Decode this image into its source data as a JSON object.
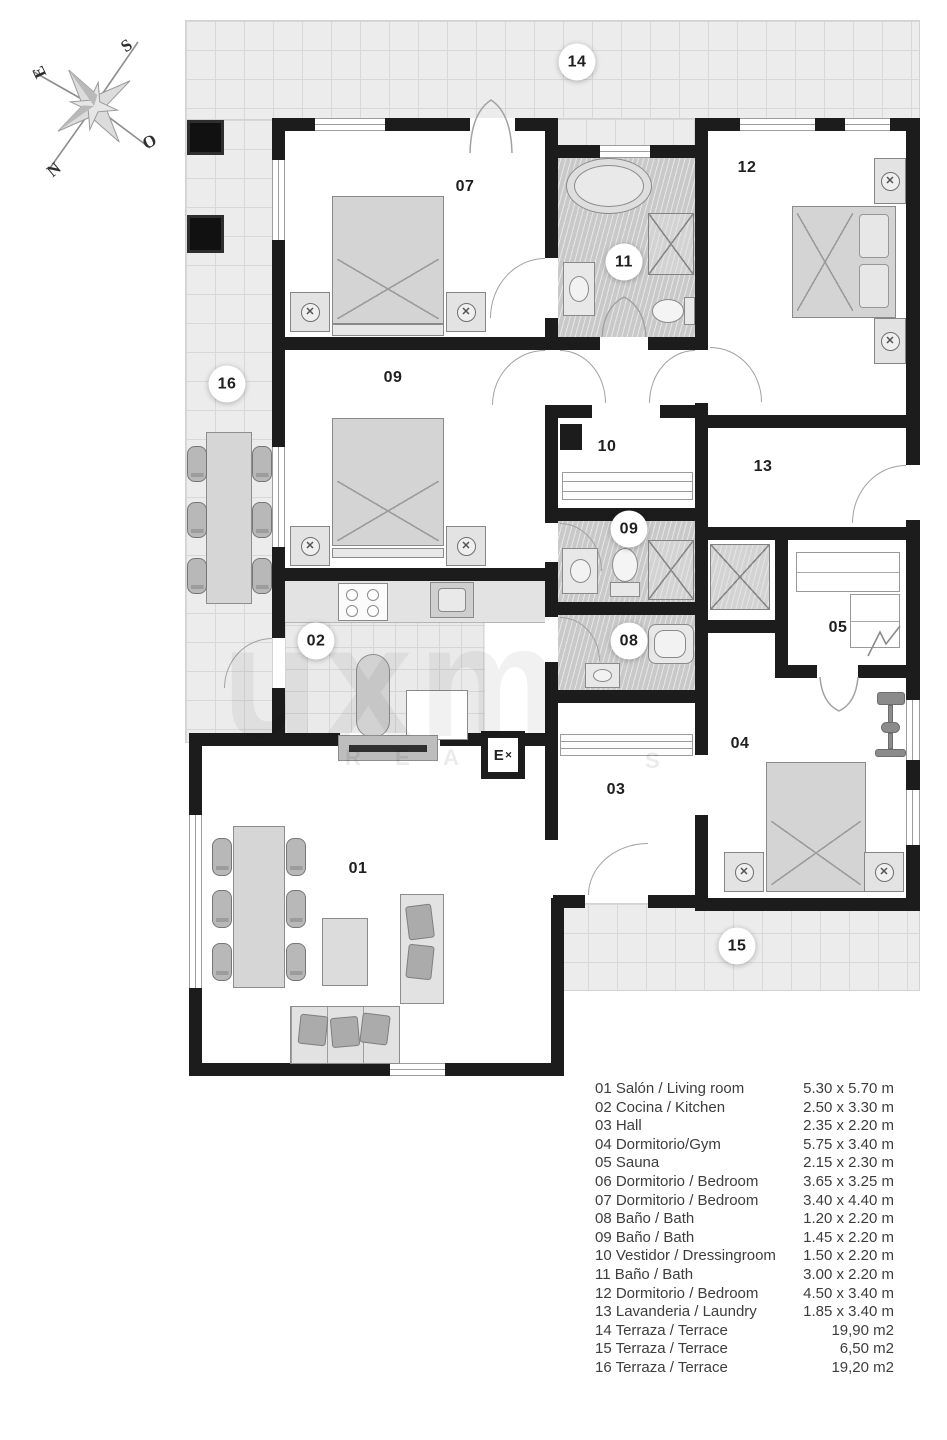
{
  "compass": {
    "n": "N",
    "s": "S",
    "e": "E",
    "o": "O"
  },
  "watermark": {
    "big": "uxm",
    "small_left": "R E A",
    "small_right": "S"
  },
  "entry": {
    "letter": "E"
  },
  "icons": {
    "lamp": "✕"
  },
  "room_labels": [
    {
      "key": "14",
      "label": "14",
      "circled": true
    },
    {
      "key": "16",
      "label": "16",
      "circled": true
    },
    {
      "key": "07",
      "label": "07",
      "circled": false
    },
    {
      "key": "11",
      "label": "11",
      "circled": true
    },
    {
      "key": "12",
      "label": "12",
      "circled": false
    },
    {
      "key": "09a",
      "label": "09",
      "circled": false
    },
    {
      "key": "10",
      "label": "10",
      "circled": false
    },
    {
      "key": "13",
      "label": "13",
      "circled": false
    },
    {
      "key": "09b",
      "label": "09",
      "circled": true
    },
    {
      "key": "05",
      "label": "05",
      "circled": false
    },
    {
      "key": "08",
      "label": "08",
      "circled": true
    },
    {
      "key": "02",
      "label": "02",
      "circled": true
    },
    {
      "key": "04",
      "label": "04",
      "circled": false
    },
    {
      "key": "03",
      "label": "03",
      "circled": false
    },
    {
      "key": "01",
      "label": "01",
      "circled": false
    },
    {
      "key": "15",
      "label": "15",
      "circled": true
    }
  ],
  "legend": {
    "rows": [
      {
        "no": "01",
        "name": "Salón / Living room",
        "size": "5.30 x 5.70 m"
      },
      {
        "no": "02",
        "name": "Cocina / Kitchen",
        "size": "2.50 x 3.30 m"
      },
      {
        "no": "03",
        "name": "Hall",
        "size": "2.35 x 2.20 m"
      },
      {
        "no": "04",
        "name": "Dormitorio/Gym",
        "size": "5.75 x 3.40 m"
      },
      {
        "no": "05",
        "name": "Sauna",
        "size": "2.15 x 2.30 m"
      },
      {
        "no": "06",
        "name": "Dormitorio / Bedroom",
        "size": "3.65 x 3.25 m"
      },
      {
        "no": "07",
        "name": "Dormitorio / Bedroom",
        "size": "3.40 x 4.40 m"
      },
      {
        "no": "08",
        "name": "Baño / Bath",
        "size": "1.20 x 2.20 m"
      },
      {
        "no": "09",
        "name": "Baño / Bath",
        "size": "1.45 x 2.20 m"
      },
      {
        "no": "10",
        "name": "Vestidor / Dressingroom",
        "size": "1.50 x 2.20 m"
      },
      {
        "no": "11",
        "name": "Baño / Bath",
        "size": "3.00 x 2.20 m"
      },
      {
        "no": "12",
        "name": "Dormitorio / Bedroom",
        "size": "4.50 x 3.40 m"
      },
      {
        "no": "13",
        "name": "Lavanderia / Laundry",
        "size": "1.85 x 3.40 m"
      },
      {
        "no": "14",
        "name": "Terraza / Terrace",
        "size": "19,90 m2"
      },
      {
        "no": "15",
        "name": "Terraza / Terrace",
        "size": "6,50 m2"
      },
      {
        "no": "16",
        "name": "Terraza / Terrace",
        "size": "19,20 m2"
      }
    ]
  }
}
